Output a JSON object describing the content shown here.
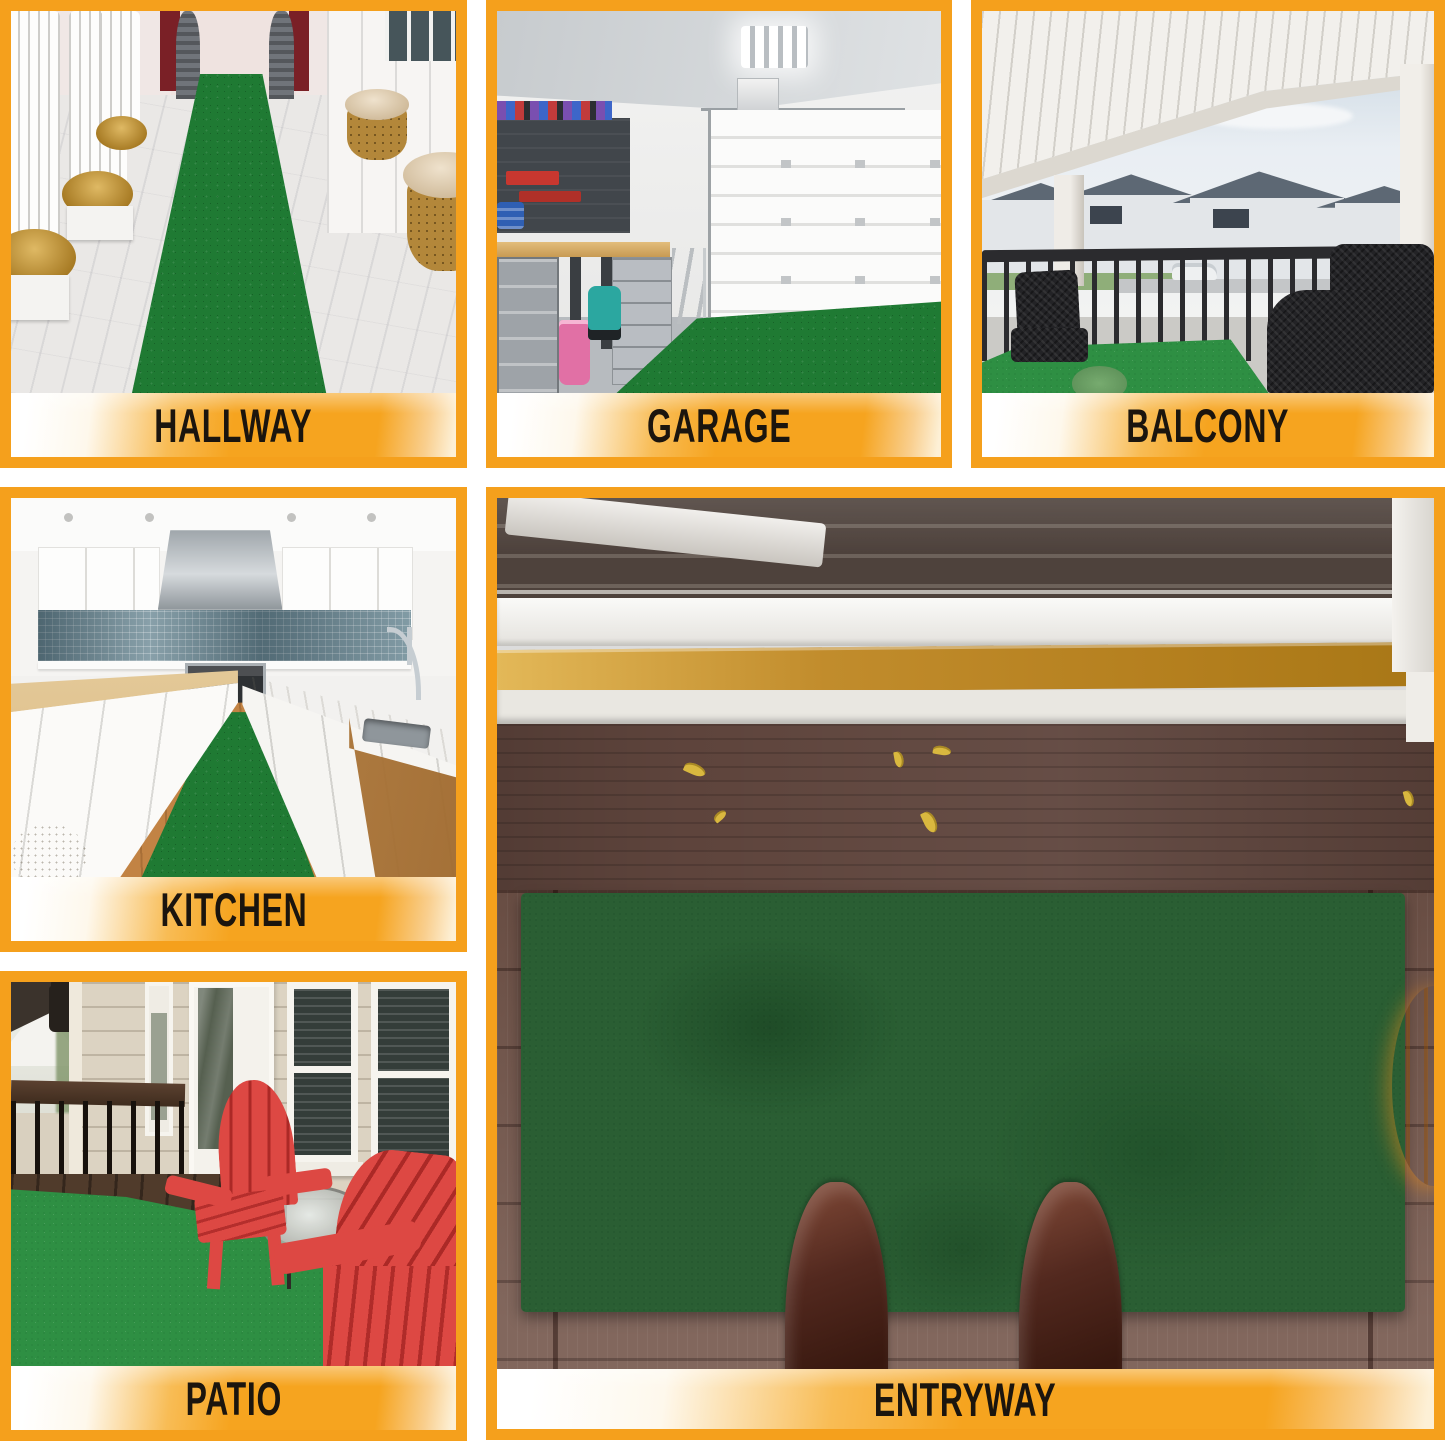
{
  "panels": [
    {
      "id": "hallway",
      "label": "HALLWAY"
    },
    {
      "id": "garage",
      "label": "GARAGE"
    },
    {
      "id": "balcony",
      "label": "BALCONY"
    },
    {
      "id": "kitchen",
      "label": "KITCHEN"
    },
    {
      "id": "patio",
      "label": "PATIO"
    },
    {
      "id": "entryway",
      "label": "ENTRYWAY"
    }
  ],
  "colors": {
    "frame_orange": "#F5A01C",
    "banner_orange": "#F6A41F",
    "label_text": "#1B150E",
    "carpet_green": "#1F7A33",
    "turf_green": "#2E8F43",
    "mat_green": "#2A5E33",
    "porch_brown": "#74564B",
    "porch_plank": "#5E443C",
    "pumpkin_orange": "#E5861C",
    "boot_brown": "#53291F",
    "adirondack_red": "#DD4843"
  }
}
